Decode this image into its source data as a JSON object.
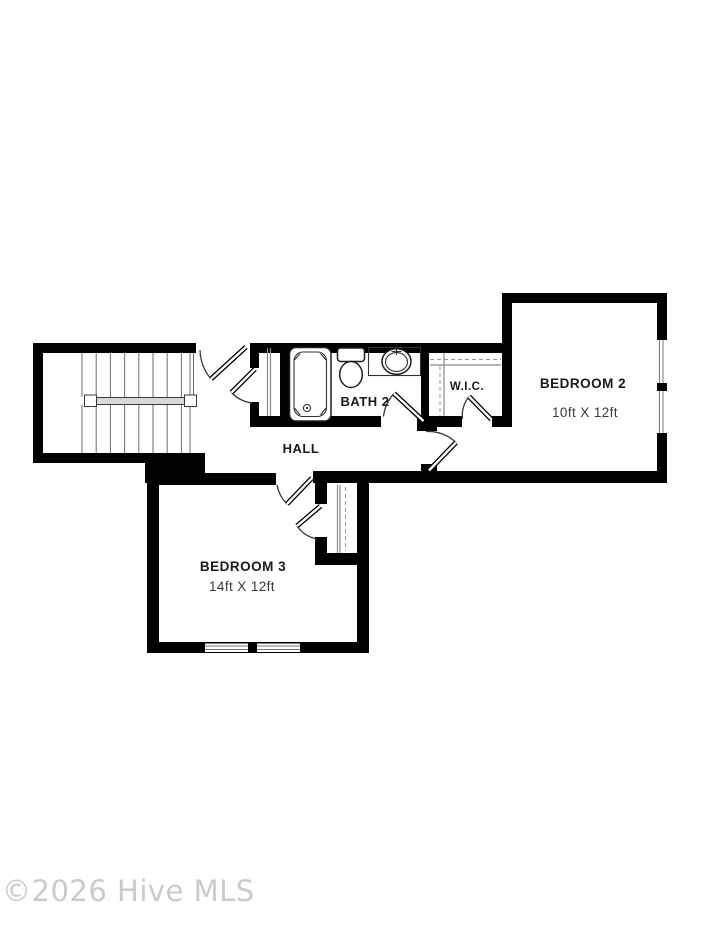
{
  "floor_plan": {
    "rooms": {
      "bedroom2": {
        "label": "BEDROOM 2",
        "dimensions": "10ft X 12ft"
      },
      "bedroom3": {
        "label": "BEDROOM 3",
        "dimensions": "14ft X 12ft"
      },
      "bath2": {
        "label": "BATH 2"
      },
      "wic": {
        "label": "W.I.C."
      },
      "hall": {
        "label": "HALL"
      }
    },
    "fixtures": [
      "staircase",
      "handrail",
      "bathtub",
      "toilet",
      "vanity-sink",
      "linen-closet",
      "wic-shelving",
      "bedroom3-closet",
      "door-swings",
      "windows"
    ],
    "colors": {
      "wall": "#000000",
      "thin_line": "#555555",
      "handrail_fill": "#d8d8d8",
      "label": "#1a1a1a",
      "dimension": "#3a3a3a",
      "watermark": "#cbcbcb"
    }
  },
  "watermark": {
    "text": "©2026 Hive MLS"
  }
}
